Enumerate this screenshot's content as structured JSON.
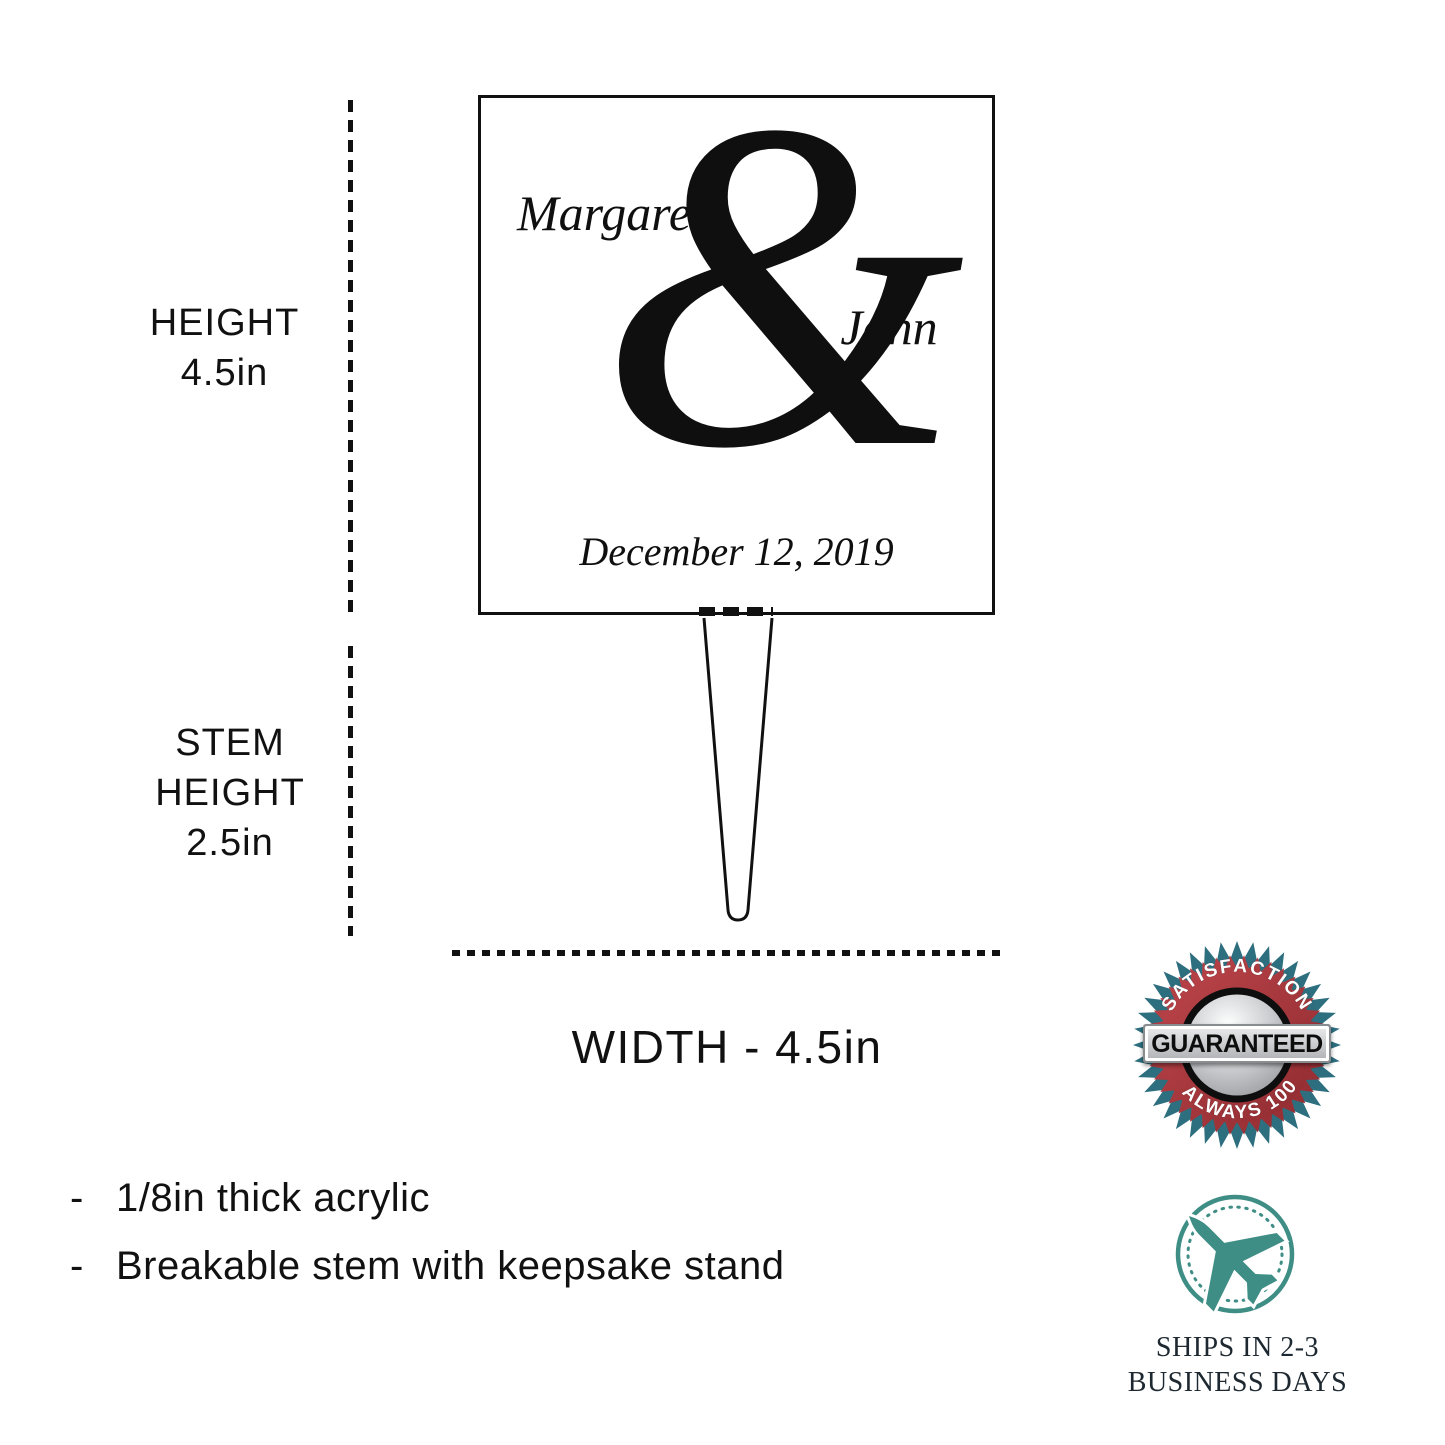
{
  "topper": {
    "name_top": "Margaret",
    "ampersand": "&",
    "name_bottom": "John",
    "date": "December 12, 2019"
  },
  "dimensions": {
    "height_label": "HEIGHT",
    "height_value": "4.5in",
    "stem_label_line1": "STEM",
    "stem_label_line2": "HEIGHT",
    "stem_value": "2.5in",
    "width_label": "WIDTH - 4.5in"
  },
  "features": [
    {
      "bullet": "-",
      "text": "1/8in thick acrylic"
    },
    {
      "bullet": "-",
      "text": "Breakable stem with keepsake stand"
    }
  ],
  "badge": {
    "icon": "guarantee-badge",
    "top_text": "SATISFACTION",
    "center_text": "GUARANTEED",
    "bottom_text": "IS ALWAYS 100%"
  },
  "shipping": {
    "icon": "airplane-in-dotted-circle",
    "line1": "SHIPS IN 2-3",
    "line2": "BUSINESS DAYS"
  },
  "colors": {
    "ink": "#111111",
    "badge_teal": "#2d6e7f",
    "badge_red": "#bc454a",
    "badge_red_dark": "#8f2b30",
    "plane_teal": "#3f8e86",
    "ships_text": "#1d2830"
  }
}
